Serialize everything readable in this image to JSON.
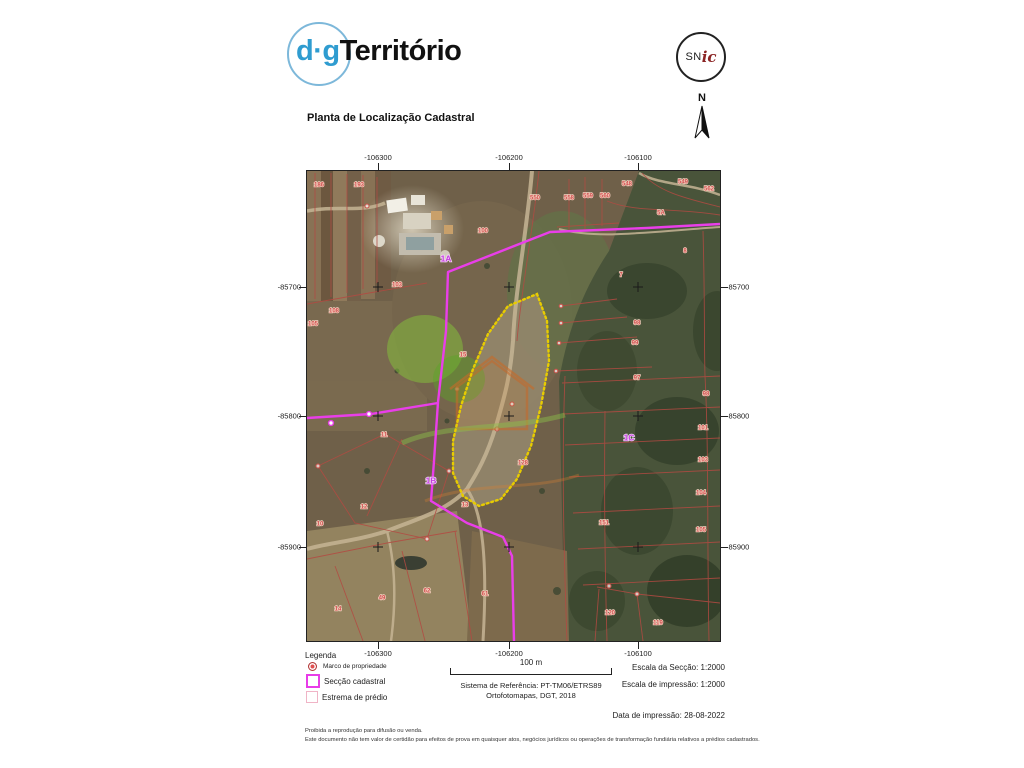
{
  "header": {
    "brand_dg": "d·g",
    "brand_territorio": "Território",
    "snic_sn": "SN",
    "snic_ic": "ic",
    "title": "Planta de Localização Cadastral",
    "north_label": "N"
  },
  "map": {
    "x_ticks": [
      "-106300",
      "-106200",
      "-106100"
    ],
    "y_ticks": [
      "-85700",
      "-85800",
      "-85900"
    ],
    "section_labels": [
      {
        "t": "1A",
        "x": 139,
        "y": 88
      },
      {
        "t": "1B",
        "x": 124,
        "y": 310
      },
      {
        "t": "1C",
        "x": 322,
        "y": 267
      }
    ],
    "parcel_labels": [
      {
        "t": "186",
        "x": 12,
        "y": 14
      },
      {
        "t": "193",
        "x": 52,
        "y": 14
      },
      {
        "t": "550",
        "x": 228,
        "y": 27
      },
      {
        "t": "558",
        "x": 262,
        "y": 27
      },
      {
        "t": "559",
        "x": 281,
        "y": 25
      },
      {
        "t": "560",
        "x": 298,
        "y": 25
      },
      {
        "t": "548",
        "x": 320,
        "y": 13
      },
      {
        "t": "549",
        "x": 376,
        "y": 11
      },
      {
        "t": "562",
        "x": 402,
        "y": 18
      },
      {
        "t": "5A",
        "x": 354,
        "y": 42
      },
      {
        "t": "100",
        "x": 176,
        "y": 60
      },
      {
        "t": "108",
        "x": 27,
        "y": 140
      },
      {
        "t": "105",
        "x": 6,
        "y": 153
      },
      {
        "t": "103",
        "x": 90,
        "y": 114
      },
      {
        "t": "8",
        "x": 378,
        "y": 80
      },
      {
        "t": "7",
        "x": 314,
        "y": 104
      },
      {
        "t": "98",
        "x": 330,
        "y": 152
      },
      {
        "t": "99",
        "x": 328,
        "y": 172
      },
      {
        "t": "97",
        "x": 330,
        "y": 207
      },
      {
        "t": "15",
        "x": 156,
        "y": 184
      },
      {
        "t": "128",
        "x": 216,
        "y": 292
      },
      {
        "t": "98",
        "x": 399,
        "y": 223
      },
      {
        "t": "101",
        "x": 396,
        "y": 257
      },
      {
        "t": "103",
        "x": 396,
        "y": 289
      },
      {
        "t": "104",
        "x": 394,
        "y": 322
      },
      {
        "t": "105",
        "x": 394,
        "y": 359
      },
      {
        "t": "11",
        "x": 77,
        "y": 264
      },
      {
        "t": "12",
        "x": 57,
        "y": 336
      },
      {
        "t": "10",
        "x": 13,
        "y": 353
      },
      {
        "t": "13",
        "x": 158,
        "y": 334
      },
      {
        "t": "14",
        "x": 31,
        "y": 438
      },
      {
        "t": "49",
        "x": 75,
        "y": 427
      },
      {
        "t": "62",
        "x": 120,
        "y": 420
      },
      {
        "t": "61",
        "x": 178,
        "y": 423
      },
      {
        "t": "151",
        "x": 297,
        "y": 352
      },
      {
        "t": "120",
        "x": 303,
        "y": 442
      },
      {
        "t": "119",
        "x": 351,
        "y": 452
      }
    ],
    "colors": {
      "seccao_cadastral": "#e93ee9",
      "estrema_predio": "#f0b4c6",
      "parcela_destacada": "#e8cc00",
      "limites_prediais": "#b34a42"
    }
  },
  "legend": {
    "title": "Legenda",
    "items": [
      {
        "label": "Marco de propriedade",
        "type": "marco"
      },
      {
        "label": "Secção cadastral",
        "type": "seccao"
      },
      {
        "label": "Estrema de prédio",
        "type": "estrema"
      }
    ]
  },
  "scalebar": {
    "label": "100 m"
  },
  "reference": {
    "line1": "Sistema de Referência: PT-TM06/ETRS89",
    "line2": "Ortofotomapas, DGT, 2018"
  },
  "scales": {
    "section": "Escala da Secção: 1:2000",
    "print": "Escala de impressão: 1:2000",
    "date": "Data de impressão: 28-08-2022"
  },
  "footer": {
    "line1": "Proibida a reprodução para difusão ou venda.",
    "line2": "Este documento não tem valor de certidão para efeitos de prova em quaisquer atos, negócios jurídicos ou operações de transformação fundiária relativos a prédios cadastrados."
  }
}
